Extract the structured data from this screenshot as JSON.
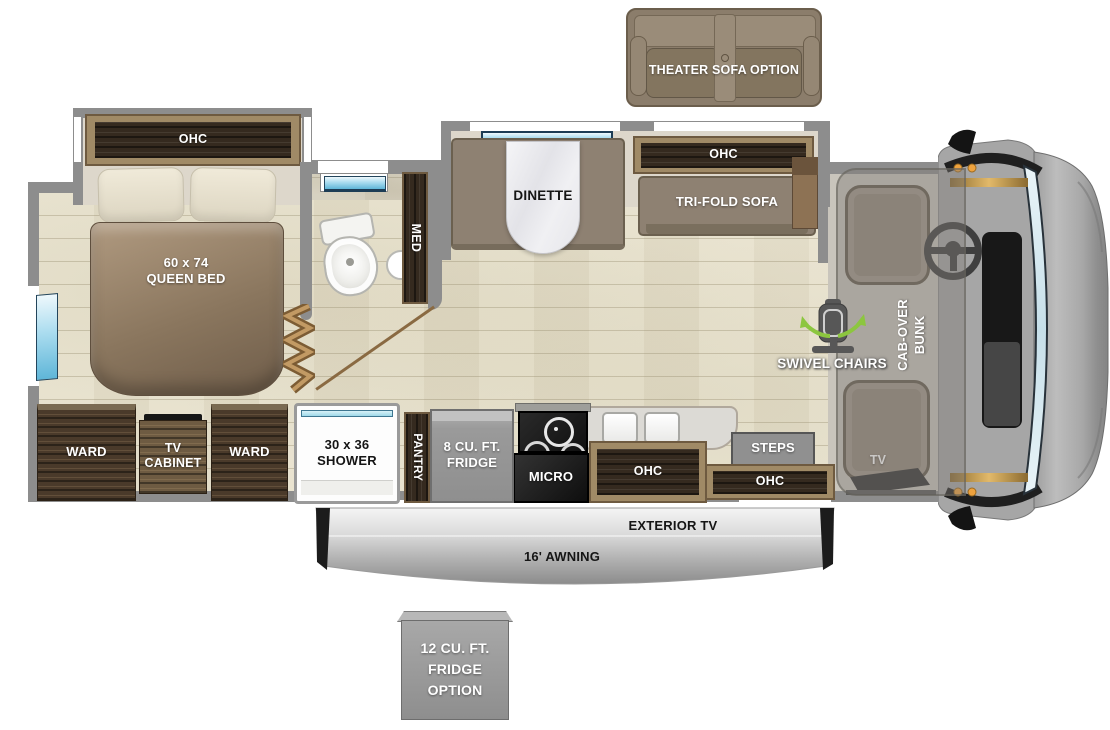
{
  "floorplan": {
    "options": {
      "theater_sofa": "THEATER SOFA OPTION",
      "fridge12": "12 CU. FT.\nFRIDGE\nOPTION"
    },
    "bedroom": {
      "ohc": "OHC",
      "bed": "60 x 74\nQUEEN BED",
      "ward_left": "WARD",
      "tv_cabinet": "TV\nCABINET",
      "ward_right": "WARD"
    },
    "bathroom": {
      "med": "MED",
      "shower": "30 x 36\nSHOWER"
    },
    "galley": {
      "pantry": "PANTRY",
      "fridge": "8 CU. FT.\nFRIDGE",
      "micro": "MICRO",
      "ohc": "OHC"
    },
    "living": {
      "dinette": "DINETTE",
      "ohc": "OHC",
      "sofa": "TRI-FOLD SOFA"
    },
    "entry": {
      "steps": "STEPS",
      "ohc": "OHC"
    },
    "cab": {
      "bunk": "CAB-OVER\nBUNK",
      "swivel": "SWIVEL CHAIRS",
      "tv": "TV"
    },
    "exterior": {
      "tv": "EXTERIOR TV",
      "awning": "16' AWNING"
    },
    "colors": {
      "wall": "#8d8d8d",
      "floor": "#e9e3cf",
      "wood_dark": "#46372a",
      "wood_frame": "#a08a66",
      "sofa": "#8e8172",
      "window_glass": "#8fd0e8",
      "accent_green": "#8cc63f",
      "awning_silver": "#c7c7c7"
    }
  }
}
